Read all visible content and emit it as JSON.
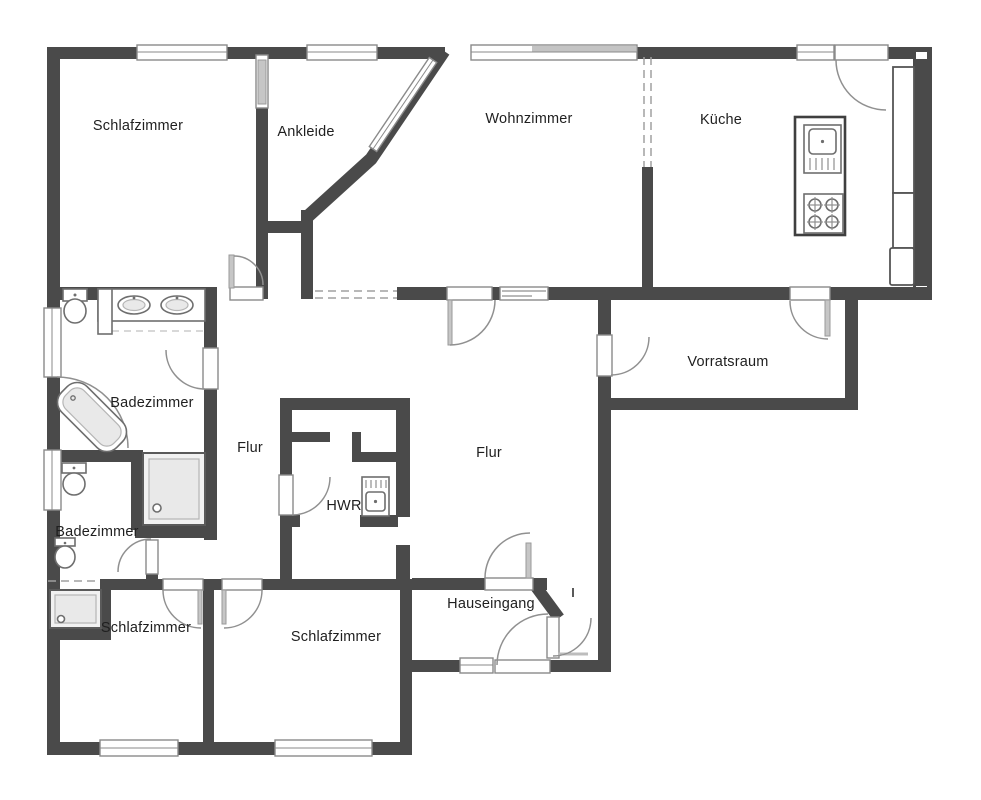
{
  "plan": {
    "type": "floor-plan",
    "language": "de"
  },
  "rooms": [
    {
      "id": "schlafzimmer-nw",
      "label": "Schlafzimmer"
    },
    {
      "id": "ankleide",
      "label": "Ankleide"
    },
    {
      "id": "wohnzimmer",
      "label": "Wohnzimmer"
    },
    {
      "id": "kueche",
      "label": "Küche"
    },
    {
      "id": "vorratsraum",
      "label": "Vorratsraum"
    },
    {
      "id": "badezimmer-gross",
      "label": "Badezimmer"
    },
    {
      "id": "flur-links",
      "label": "Flur"
    },
    {
      "id": "flur-mitte",
      "label": "Flur"
    },
    {
      "id": "hwr",
      "label": "HWR"
    },
    {
      "id": "badezimmer-klein",
      "label": "Badezimmer"
    },
    {
      "id": "schlafzimmer-sw",
      "label": "Schlafzimmer"
    },
    {
      "id": "schlafzimmer-sm",
      "label": "Schlafzimmer"
    },
    {
      "id": "hauseingang",
      "label": "Hauseingang"
    }
  ],
  "colors": {
    "wall": "#4a4a4a",
    "door_arc": "#909090",
    "window_frame": "#8a8a8a",
    "fixture_outline": "#6e6e6e",
    "text": "#1f1f1f",
    "background": "#ffffff"
  }
}
